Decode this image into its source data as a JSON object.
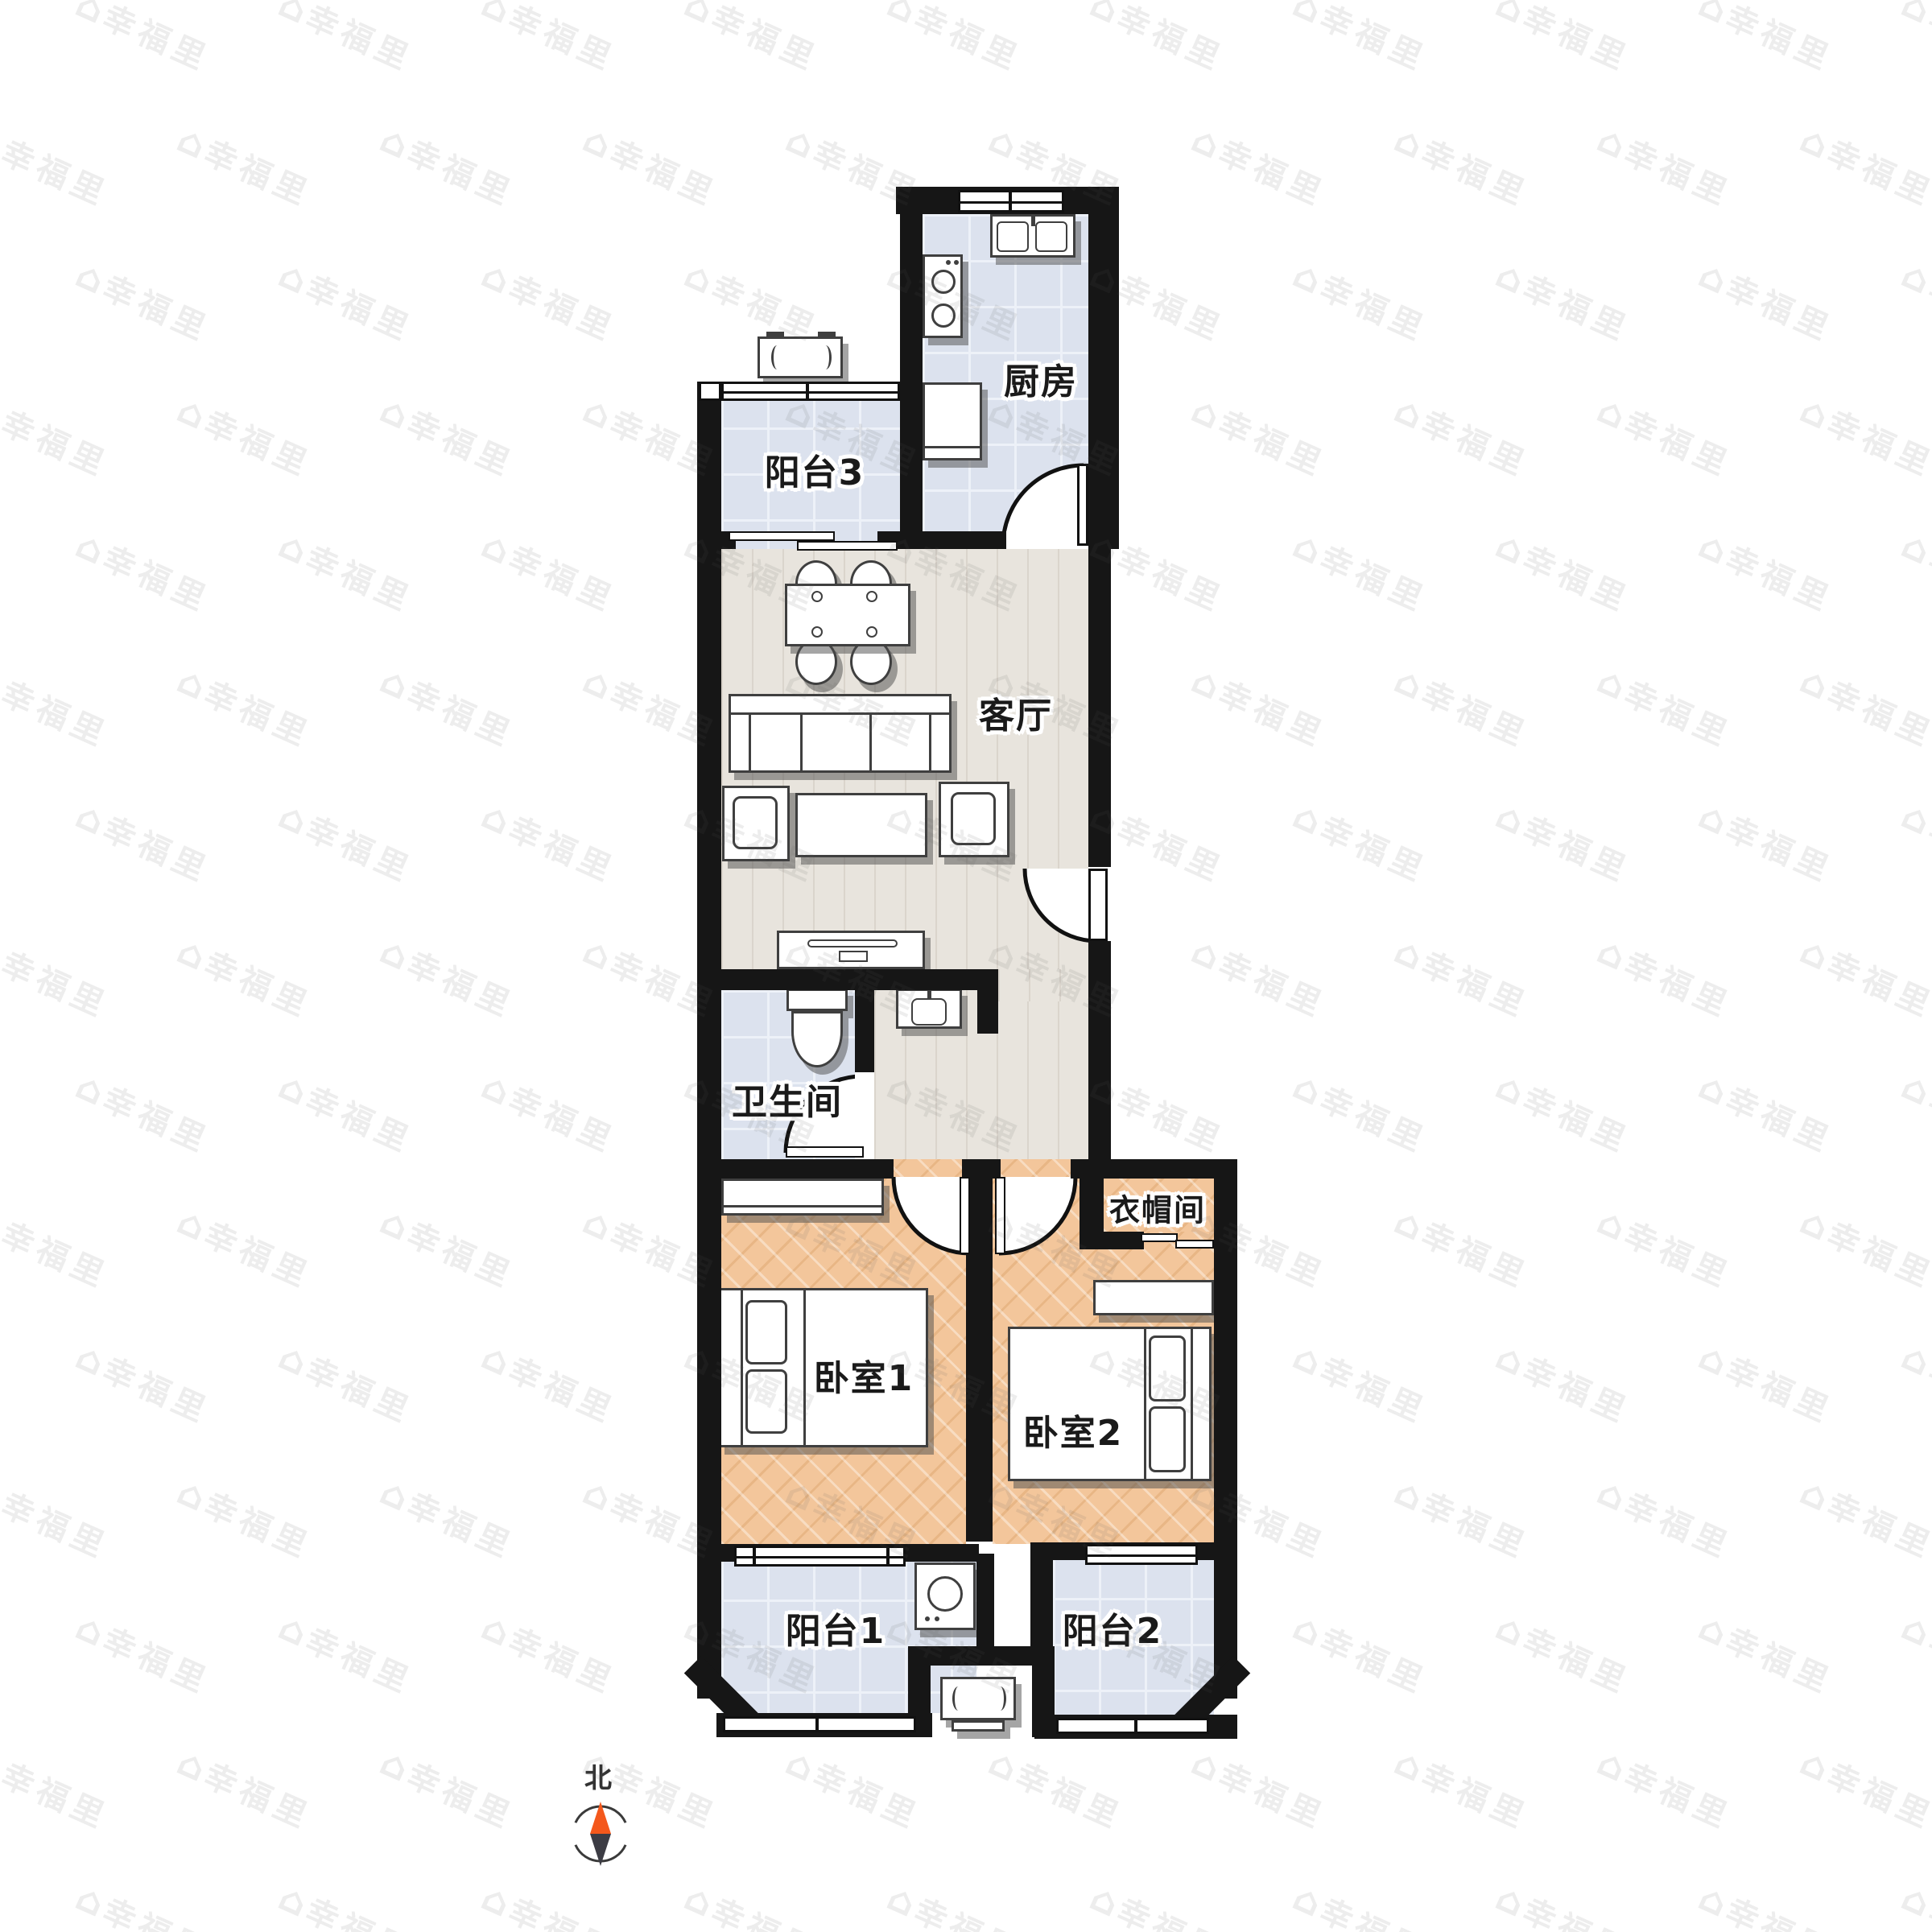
{
  "watermark": {
    "text": "幸福里",
    "icon_glyph": "⌂"
  },
  "compass": {
    "north_label": "北"
  },
  "rooms": {
    "kitchen": {
      "label": "厨房"
    },
    "balcony3": {
      "label": "阳台3"
    },
    "living_room": {
      "label": "客厅"
    },
    "bathroom": {
      "label": "卫生间"
    },
    "cloakroom": {
      "label": "衣帽间"
    },
    "bedroom1": {
      "label": "卧室1"
    },
    "bedroom2": {
      "label": "卧室2"
    },
    "balcony1": {
      "label": "阳台1"
    },
    "balcony2": {
      "label": "阳台2"
    }
  },
  "colors": {
    "wall": "#161616",
    "tile_floor": "#dce2ee",
    "wood_floor": "#e8e4dd",
    "herringbone_floor": "#f3c69b",
    "compass_north": "#f4581c",
    "compass_south": "#3c3c44"
  }
}
